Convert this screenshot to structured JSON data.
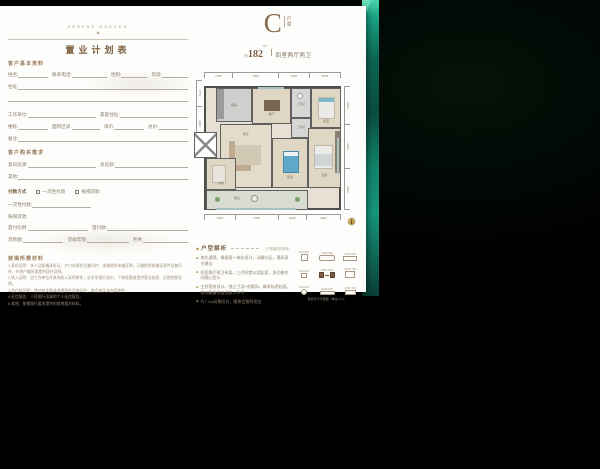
{
  "header": {
    "brand": "SERENE GARDEN",
    "ornament": "◆",
    "title": "置业计划表"
  },
  "form": {
    "section_basic": "客户基本资料",
    "section_demand": "客户购买需求",
    "rows": {
      "r1": [
        "姓名:",
        "联系电话:",
        "性别:",
        "年龄:"
      ],
      "r2": [
        "住址:"
      ],
      "r4": [
        "工作单位:",
        "家庭住址:"
      ],
      "r5": [
        "楼栋:",
        "面积区间:",
        "单价:",
        "总价:"
      ],
      "r6": [
        "备注:"
      ],
      "r7": [
        "意向房源:",
        "总房款:"
      ],
      "r8": [
        "其他:"
      ],
      "r10": [
        "一次性付款:"
      ],
      "r11": [
        "按揭贷款:"
      ],
      "r12": [
        "首付比例:",
        "首付款:"
      ],
      "r13": [
        "贷款额:",
        "贷款年限:",
        "月供:"
      ]
    },
    "payment": {
      "label": "付款方式",
      "options": [
        "一次性付款",
        "按揭贷款"
      ]
    },
    "section_materials": "按揭所需材料",
    "materials": [
      "1.身份证明：本人及配偶身份证、户口本原件及复印件；未婚提供未婚证明，已婚提供结婚证原件及复印件，外地户籍另需提供居住证明。",
      "2.收入证明：由工作单位开具的收入证明原件，近半年银行流水；个体经营者提供营业执照、近期完税证明。",
      "3.首付款证明：首付款发票或收据原件及复印件，商品房买卖合同原件。",
      "4.征信报告：人民银行出具的个人征信报告。",
      "5.其他：按揭银行要求提供的其他相关材料。"
    ]
  },
  "unit": {
    "letter": "C",
    "type_label": "户型",
    "area_prefix": "约",
    "area": "182",
    "area_unit": "m²",
    "spec": "四室两厅两卫"
  },
  "plan": {
    "dims_top": [
      "2750",
      "4500",
      "3000",
      "3050"
    ],
    "dims_bottom": [
      "3300",
      "4500",
      "3000",
      "3600"
    ],
    "dims_right": [
      "3600",
      "4200",
      "3900"
    ],
    "dims_left": [
      "2750",
      "3600"
    ],
    "rooms": {
      "kitchen": "厨房",
      "dining": "餐厅",
      "bath1": "卫生间",
      "bed3": "卧室",
      "living": "客厅",
      "bed2": "卧室",
      "bath2": "卫生间",
      "master": "主卧",
      "study": "书房",
      "balcony": "阳台",
      "elevator": "电梯"
    }
  },
  "analysis": {
    "marker": "◆",
    "heading": "户型解析",
    "note": "（户型图仅供参考）",
    "bullets": [
      "南北通透，餐客厨一体化设计，动静分区，通风采光俱佳",
      "四室两厅两卫布局，三代同堂从容起居，多功能空间随心定义",
      "主卧套房设计，独立卫浴+衣帽间，尊享私密起居，南向飘窗把自然收入怀中",
      "约7.1m阔景阳台，瞰景会客两相宜"
    ]
  },
  "legend": {
    "caption": "家具尺寸示意图（单位:mm）",
    "items": [
      {
        "label": "800×800"
      },
      {
        "label": "2400×900"
      },
      {
        "label": "2000×900"
      },
      {
        "label": "450×450"
      },
      {
        "label": "1800×2000"
      },
      {
        "label": "1500×700"
      },
      {
        "label": "600×600"
      },
      {
        "label": "2200×600"
      },
      {
        "label": "1400×700"
      }
    ]
  }
}
